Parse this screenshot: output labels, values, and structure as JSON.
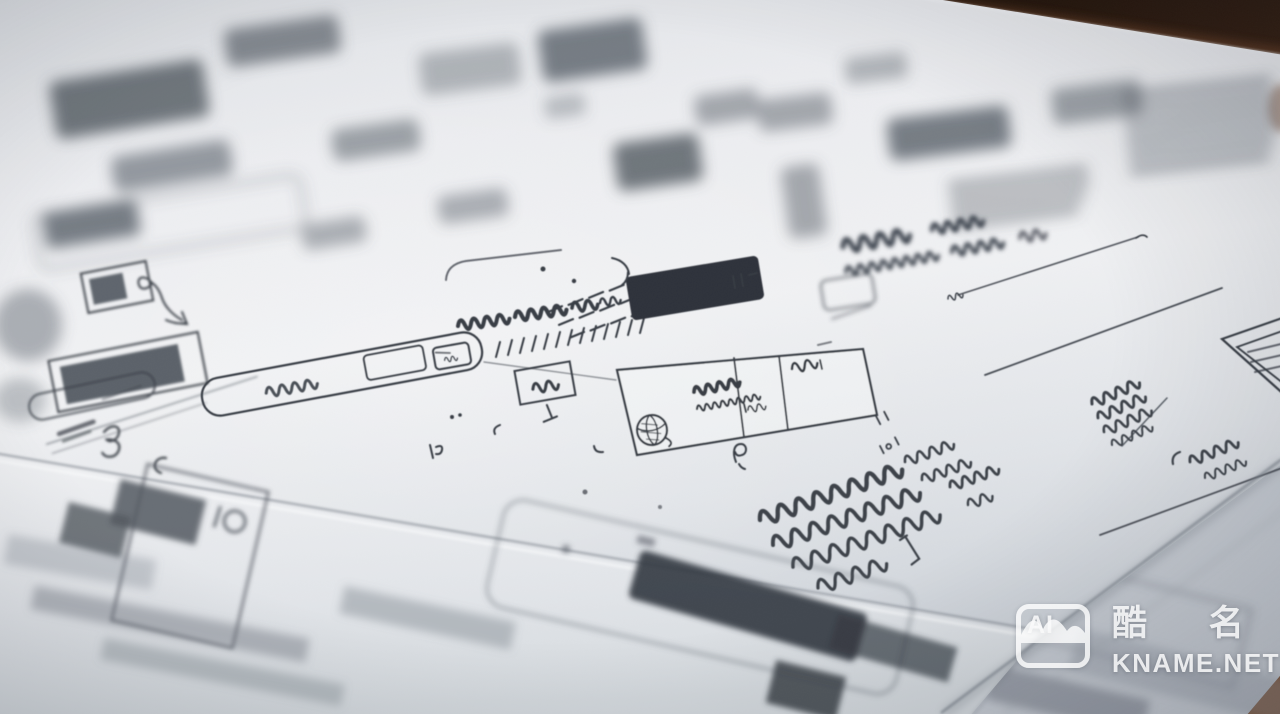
{
  "scene": {
    "type": "photograph",
    "subject": "Close-up photo of hand-drawn UI wireframe sketches on white paper sheets lying on a dark wooden desk, shot at a low oblique angle with shallow depth of field; scribbled pseudo-text, boxes, buttons and annotation notes; only a diagonal middle band is in focus",
    "colors": {
      "wood_dark": "#140c07",
      "wood_mid": "#47291717",
      "wood_light": "#7c4a2b",
      "paper_light": "#f1f2f4",
      "paper_mid": "#e6e9ec",
      "paper_dark": "#ccd1d7",
      "ink": "#383d45",
      "ink_soft": "#596069",
      "button_fill": "#2e333a"
    }
  },
  "watermark": {
    "icon_label": "AI",
    "brand_cn": "酷 名",
    "site": "KNAME.NET"
  }
}
